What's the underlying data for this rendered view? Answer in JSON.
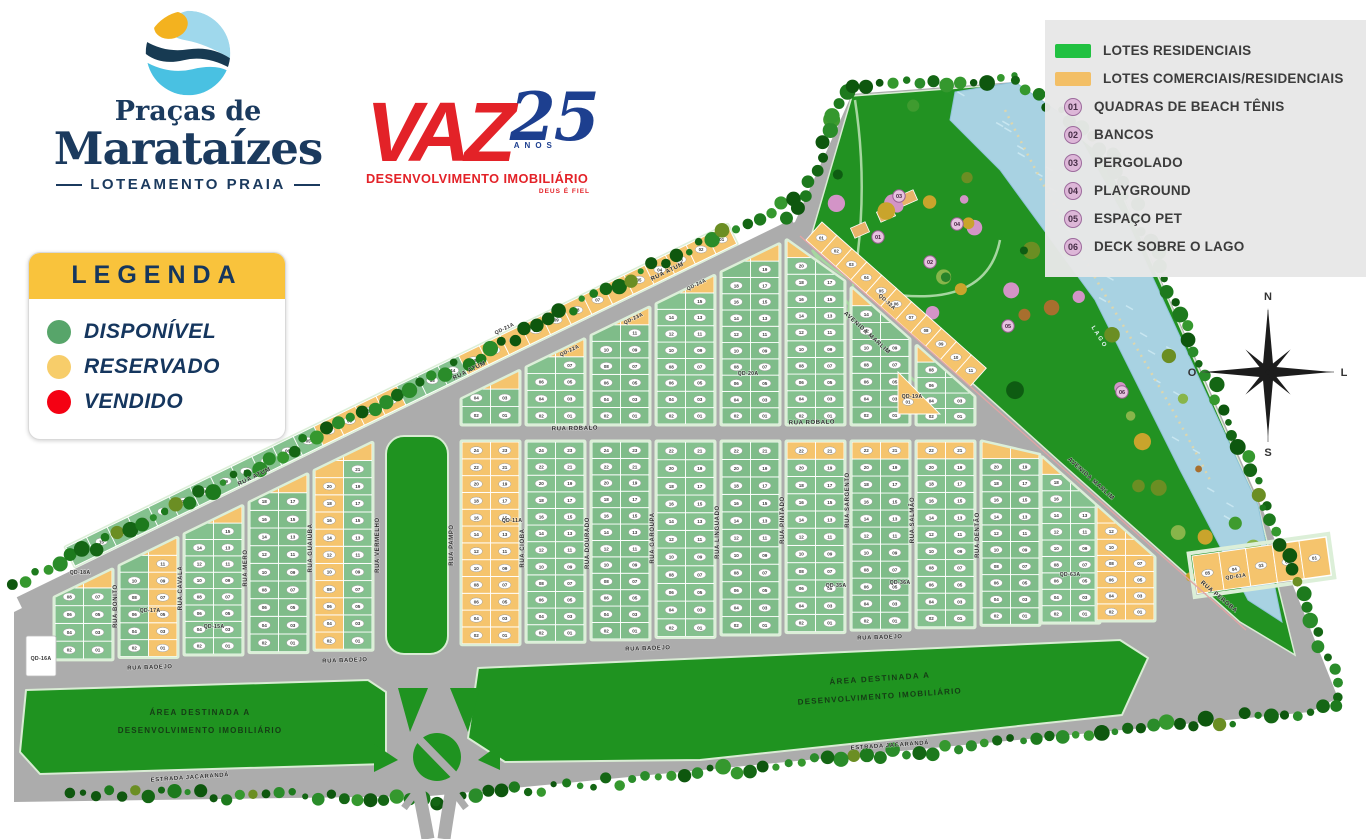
{
  "branding": {
    "name_top": "Praças de",
    "name_main": "Marataízes",
    "subtitle": "LOTEAMENTO PRAIA"
  },
  "developer": {
    "name": "VAZ",
    "years": "25",
    "years_label": "ANOS",
    "tagline": "DESENVOLVIMENTO IMOBILIÁRIO",
    "motto": "DEUS É FIEL"
  },
  "legenda": {
    "title": "LEGENDA",
    "items": [
      {
        "label": "DISPONÍVEL",
        "color": "#57a56a"
      },
      {
        "label": "RESERVADO",
        "color": "#f7cd6a"
      },
      {
        "label": "VENDIDO",
        "color": "#f40113"
      }
    ]
  },
  "map_legend": {
    "swatches": [
      {
        "label": "LOTES RESIDENCIAIS",
        "color": "#21c141"
      },
      {
        "label": "LOTES COMERCIAIS/RESIDENCIAIS",
        "color": "#f3bf66"
      }
    ],
    "amenities": [
      {
        "number": "01",
        "label": "QUADRAS DE BEACH TÊNIS"
      },
      {
        "number": "02",
        "label": "BANCOS"
      },
      {
        "number": "03",
        "label": "PERGOLADO"
      },
      {
        "number": "04",
        "label": "PLAYGROUND"
      },
      {
        "number": "05",
        "label": "ESPAÇO PET"
      },
      {
        "number": "06",
        "label": "DECK SOBRE O LAGO"
      }
    ]
  },
  "compass": {
    "north": "N",
    "south": "S",
    "west": "O",
    "east": "L"
  },
  "map": {
    "area_label": [
      "ÁREA DESTINADA A",
      "DESENVOLVIMENTO IMOBILIÁRIO"
    ],
    "lake_label": "LAGO",
    "lot_numbering": "lotes numerados 01–37 por quadra",
    "streets": [
      {
        "name": "RUA ATUM",
        "labels": [
          [
            255,
            478,
            -26
          ],
          [
            470,
            372,
            -26
          ],
          [
            668,
            273,
            -26
          ]
        ]
      },
      {
        "name": "RUA ROBALO",
        "labels": [
          [
            575,
            430,
            -1
          ],
          [
            812,
            424,
            -1
          ]
        ]
      },
      {
        "name": "RUA BADEJO",
        "labels": [
          [
            150,
            669,
            -2
          ],
          [
            345,
            662,
            -2
          ],
          [
            648,
            650,
            -2
          ],
          [
            880,
            639,
            -2
          ]
        ]
      },
      {
        "name": "ESTRADA JACARANDÁ",
        "labels": [
          [
            190,
            779,
            -4
          ],
          [
            890,
            747,
            -4
          ]
        ]
      },
      {
        "name": "AVENIDA MARLIM",
        "labels": [
          [
            866,
            334,
            42
          ],
          [
            1090,
            480,
            42
          ]
        ]
      },
      {
        "name": "RUA BONITO",
        "labels": [
          [
            117,
            606,
            -90
          ]
        ]
      },
      {
        "name": "RUA CAVALA",
        "labels": [
          [
            182,
            588,
            -90
          ]
        ]
      },
      {
        "name": "RUA MERO",
        "labels": [
          [
            247,
            568,
            -90
          ]
        ]
      },
      {
        "name": "RUA GUAIÚBA",
        "labels": [
          [
            312,
            548,
            -90
          ]
        ]
      },
      {
        "name": "RUA VERMELHO",
        "labels": [
          [
            379,
            545,
            -90
          ]
        ]
      },
      {
        "name": "RUA PAMPO",
        "labels": [
          [
            453,
            545,
            -90
          ]
        ]
      },
      {
        "name": "RUA CIOBA",
        "labels": [
          [
            524,
            548,
            -90
          ]
        ]
      },
      {
        "name": "RUA DOURADO",
        "labels": [
          [
            589,
            543,
            -90
          ]
        ]
      },
      {
        "name": "RUA GAROUPA",
        "labels": [
          [
            654,
            538,
            -90
          ]
        ]
      },
      {
        "name": "RUA LINGUADO",
        "labels": [
          [
            719,
            532,
            -90
          ]
        ]
      },
      {
        "name": "RUA PINTADO",
        "labels": [
          [
            784,
            520,
            -90
          ]
        ]
      },
      {
        "name": "RUA SARGENTO",
        "labels": [
          [
            849,
            500,
            -90
          ]
        ]
      },
      {
        "name": "RUA SALMÃO",
        "labels": [
          [
            914,
            520,
            -90
          ]
        ]
      },
      {
        "name": "RUA DENTÃO",
        "labels": [
          [
            979,
            535,
            -90
          ]
        ]
      },
      {
        "name": "RUA PEROBA",
        "labels": [
          [
            1218,
            598,
            40
          ]
        ]
      }
    ],
    "quadras": [
      {
        "label": "QD-18A",
        "x": 80,
        "y": 574,
        "r": 0
      },
      {
        "label": "QD-17A",
        "x": 150,
        "y": 612,
        "r": 0
      },
      {
        "label": "QD-15A",
        "x": 214,
        "y": 628,
        "r": 0
      },
      {
        "label": "QD-16A",
        "x": 41,
        "y": 660,
        "r": 0
      },
      {
        "label": "QD-11A",
        "x": 512,
        "y": 522,
        "r": 0
      },
      {
        "label": "QD-21A",
        "x": 505,
        "y": 330,
        "r": -26
      },
      {
        "label": "QD-22A",
        "x": 570,
        "y": 352,
        "r": -26
      },
      {
        "label": "QD-23A",
        "x": 634,
        "y": 320,
        "r": -26
      },
      {
        "label": "QD-24A",
        "x": 697,
        "y": 286,
        "r": -26
      },
      {
        "label": "QD-20A",
        "x": 748,
        "y": 375,
        "r": 0
      },
      {
        "label": "QD-35A",
        "x": 836,
        "y": 587,
        "r": 0
      },
      {
        "label": "QD-36A",
        "x": 900,
        "y": 584,
        "r": 0
      },
      {
        "label": "QD-32A",
        "x": 886,
        "y": 303,
        "r": 42
      },
      {
        "label": "QD-19A",
        "x": 912,
        "y": 398,
        "r": 0
      },
      {
        "label": "QD-63A",
        "x": 1070,
        "y": 576,
        "r": 0
      },
      {
        "label": "QD-61A",
        "x": 1236,
        "y": 578,
        "r": -8
      }
    ],
    "amenity_markers": [
      {
        "number": "01",
        "x": 878,
        "y": 237
      },
      {
        "number": "02",
        "x": 930,
        "y": 262
      },
      {
        "number": "03",
        "x": 899,
        "y": 196
      },
      {
        "number": "04",
        "x": 957,
        "y": 224
      },
      {
        "number": "05",
        "x": 1008,
        "y": 326
      },
      {
        "number": "06",
        "x": 1122,
        "y": 392
      }
    ],
    "colors": {
      "road": "#acacac",
      "lot_green": "#84c18e",
      "lot_green2": "#7fbc89",
      "lot_yellow": "#f5c46d",
      "park": "#229222",
      "dev": "#1f9320",
      "lake": "#a8d2e2",
      "fringe": "#1b7a1b",
      "mint": "#dcefd8"
    }
  }
}
